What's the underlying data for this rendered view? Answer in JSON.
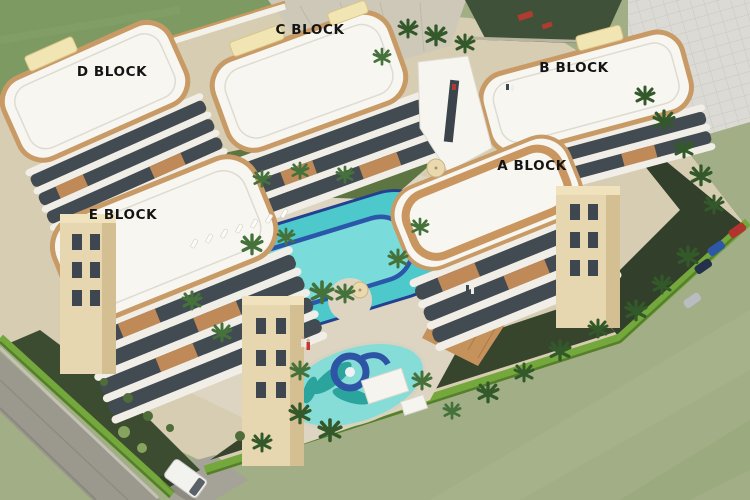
{
  "scene": {
    "labels": [
      {
        "id": "c-block",
        "text": "C BLOCK"
      },
      {
        "id": "d-block",
        "text": "D BLOCK"
      },
      {
        "id": "b-block",
        "text": "B BLOCK"
      },
      {
        "id": "a-block",
        "text": "A BLOCK"
      },
      {
        "id": "e-block",
        "text": "E BLOCK"
      }
    ],
    "colors": {
      "grass_light": "#a2ae86",
      "grass_dark": "#7d9a62",
      "road": "#9b998e",
      "hedge": "#74a83c",
      "pool_water": "#4ec9cb",
      "pool_inner": "#7adcda",
      "pool_rim": "#2b57a8",
      "roof_trim": "#c89a66",
      "building_white": "#f7f6f1",
      "glass": "#434b52",
      "tower_beige": "#e7d7b0",
      "slide_blue": "#2d54a5"
    },
    "objects": [
      "swimming-pool",
      "kids-pool",
      "water-slide",
      "perimeter-hedge",
      "palm-trees",
      "sun-loungers",
      "parasols",
      "road",
      "white-van",
      "parking-cars",
      "playground",
      "apartment-blocks"
    ]
  }
}
